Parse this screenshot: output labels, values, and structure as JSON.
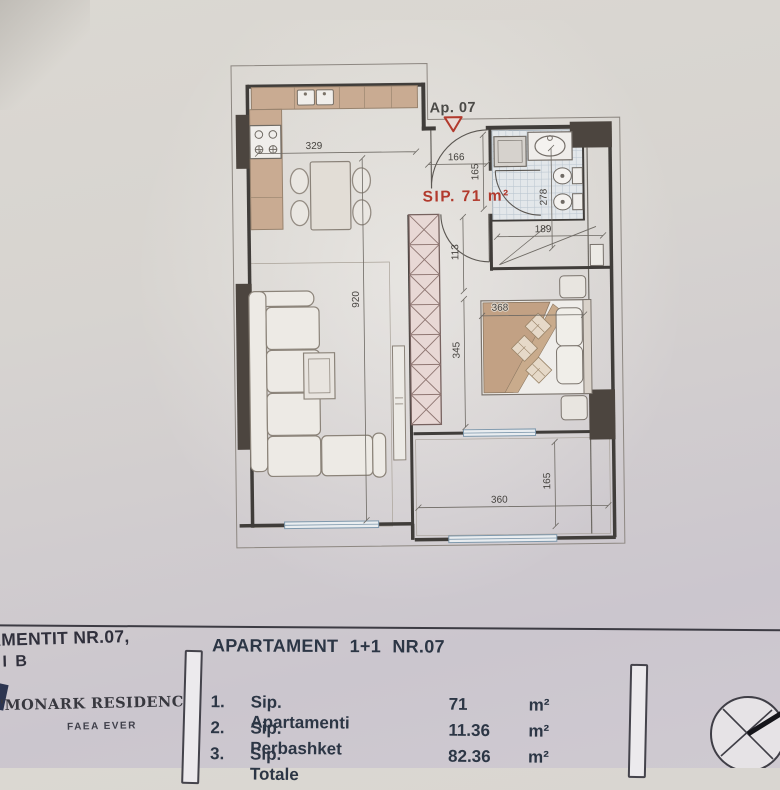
{
  "plan": {
    "apartment_label": "Ap. 07",
    "area_label": "SIP. 71 m²",
    "dims": {
      "kitchen_width": "329",
      "hall_width": "166",
      "hall_depth": "165",
      "living_depth": "920",
      "closet_top": "113",
      "bedroom_depth": "345",
      "bed_width": "368",
      "bath_depth": "278",
      "bath_width": "189",
      "balcony_width": "360",
      "balcony_depth": "165"
    }
  },
  "title_block": {
    "left_text_line1": "AMENTIT NR.07,",
    "left_text_line2": "NI B",
    "company_name": "\"MONARK RESIDENCE\"",
    "company_subtitle": "FAEA EVER",
    "table_title": "APARTAMENT 1+1 NR.07",
    "rows": [
      {
        "no": "1.",
        "label": "Sip. Apartamenti",
        "value": "71",
        "unit": "m²"
      },
      {
        "no": "2.",
        "label": "Sip. Perbashket",
        "value": "11.36",
        "unit": "m²"
      },
      {
        "no": "3.",
        "label": "Sip. Totale",
        "value": "82.36",
        "unit": "m²"
      }
    ]
  },
  "colors": {
    "red_accent": "#b23a2d",
    "table_text": "#2c3645",
    "wood": "#c9ab92"
  }
}
